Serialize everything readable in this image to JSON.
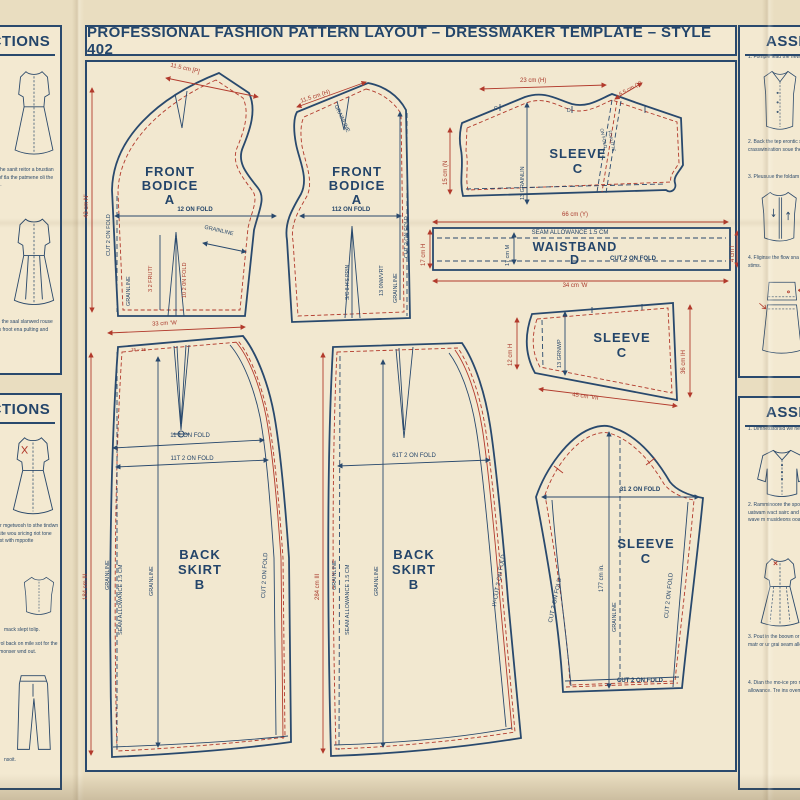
{
  "title": "PROFESSIONAL FASHION PATTERN LAYOUT – DRESSMAKER TEMPLATE – STYLE 402",
  "colors": {
    "navy": "#29496d",
    "red": "#b23a2c",
    "paper": "#e9ddc0",
    "panel": "#f3e9d1"
  },
  "sidebar_left_top": {
    "header": "INSTRUCTIONS",
    "para1": "se gloin the sanit reitor a brustian posilion of tla the patmene oli the astanoos.",
    "para2": "sa 2 time the saal slanwed rouse that lmcis froot ena pulting and hetils."
  },
  "sidebar_left_bottom": {
    "header": "INSTRUCTIONS",
    "para1": "soe oikter mgetwosh to sthe tindwn nom masite wou sricing riot tone sune lacist with mppotte",
    "caption1": "mack slept tolip.",
    "para2": "sanes, orol back on mile sot for the slip with monser wnd out.",
    "caption2": "nsoit."
  },
  "sidebar_right_top": {
    "header": "ASSEMBLY",
    "item1": "1. Fomple lead the new waigobi paytens.",
    "item2": "2. Back the tep erontic sters and endy tootectra sontrical crasswiniration soue the steam withot.",
    "item3": "3. Pleusuue the foldam repesess roan with athe.",
    "tag": "D",
    "item4": "4. Fliginse the flow sna fom and waittiaseek the to the stims."
  },
  "sidebar_right_bottom": {
    "header": "ASSEMBLY",
    "item1": "1. Dimnesstorsid we nec lvetisehis pantenn.",
    "item2": "2. Ramminoore the spo hueben motlwovin inye an andrt uatwam wact sairc and tiloro'e selecc osait tilow oam wave m musideons ooamialp. S coomhleta.",
    "item3": "3. Pout in the boown or oeof on foeuroold i lae aad hebs matr or ur grai seam allowaner on slide and set marh.",
    "item4": "4. Dian the mo-ice pro mosten to the seam o orain allowance. Tre ins ovement exams the wa."
  },
  "pieces": {
    "bodice_left": {
      "front": "FRONT",
      "bodice": "BODICE",
      "letter": "A",
      "fold": "12 ON FOLD",
      "grain_diag": "GRAINLINE",
      "cut": "CUT 2 ON FOLD",
      "grain_v": "GRAINLINE",
      "t1": "3 2 FRUTI'",
      "t2": "10 2 0N FOLD",
      "dim_top": "11.5 cm [P]",
      "dim_left": "43 cm N'"
    },
    "bodice_right": {
      "front": "FRONT",
      "bodice": "BODICE",
      "letter": "A",
      "fold": "112 ON FOLD",
      "dim_top": "11.5 cm (H)",
      "cut": "CUT 2 ON FOLD",
      "grain_diag": "GRAINLINE",
      "grain_v": "GRAINLINE",
      "t1": "13 0NWVRT",
      "t2": "S/C 8 H'S PRIN"
    },
    "sleeve_top": {
      "name": "SLEEVE",
      "letter": "C",
      "dim_top": "23 cm (H)",
      "dim_diag": "6.5 cm (Y)",
      "dim_left": "15 cm (N",
      "grain": "13 GRAINLIN",
      "notch1": "C",
      "notch2": "D",
      "seam1": "ON FOLD",
      "seam2": "FOALITTE"
    },
    "waistband": {
      "name": "WAISTBAND",
      "letter": "D",
      "seam": "SEAM ALLOWANCE 1.5 CM",
      "cut": "CUT 2 ON FOLD",
      "dim_top": "66 cm (Y)",
      "dim_bottom": "34 cm 'W",
      "dim_left_red": "17 cm H",
      "dim_left_blue": "17 cm M",
      "dim_right": "4 cm l"
    },
    "sleeve_small": {
      "name": "SLEEVE",
      "letter": "C",
      "dim_left": "12 cm H",
      "dim_right": "36 cm IH",
      "dim_bottom": "45 cm 'VII",
      "grain": "13 GRNWP"
    },
    "sleeve_big": {
      "name": "SLEEVE",
      "letter": "C",
      "fold": "31 2 ON FOLD",
      "dim": "177 cm in.",
      "grain": "GRAINLINE",
      "cut_left": "CUT 2 ON FOLD",
      "cut_right": "CUT 2 ON FOLD",
      "cut_bottom": "CUT 2 ON FOLD"
    },
    "skirt_left": {
      "back": "BACK",
      "skirt": "SKIRT",
      "letter": "B",
      "dim_top": "33 cm 'W",
      "ticks": "15 – 15",
      "fold1": "11 1 ON FOLD",
      "fold2": "11T 2 ON FOLD",
      "dim_left": "184 cm III",
      "grain1": "GRAINLINE",
      "seam": "SEAM ALLOWANCE 1.5 CM",
      "grain2": "GRAINLINE",
      "cut": "CUT 2 ON FOLD"
    },
    "skirt_mid": {
      "back": "BACK",
      "skirt": "SKIRT",
      "letter": "B",
      "fold": "61T 2 ON FOLD",
      "dim_left": "284 cm III",
      "grain1": "GRAINLINE",
      "seam": "SEAM ALLOWANCE 1.5 CM",
      "grain2": "GRAINLINE",
      "cut": "IY-CUT 2 ON FOLD"
    }
  }
}
